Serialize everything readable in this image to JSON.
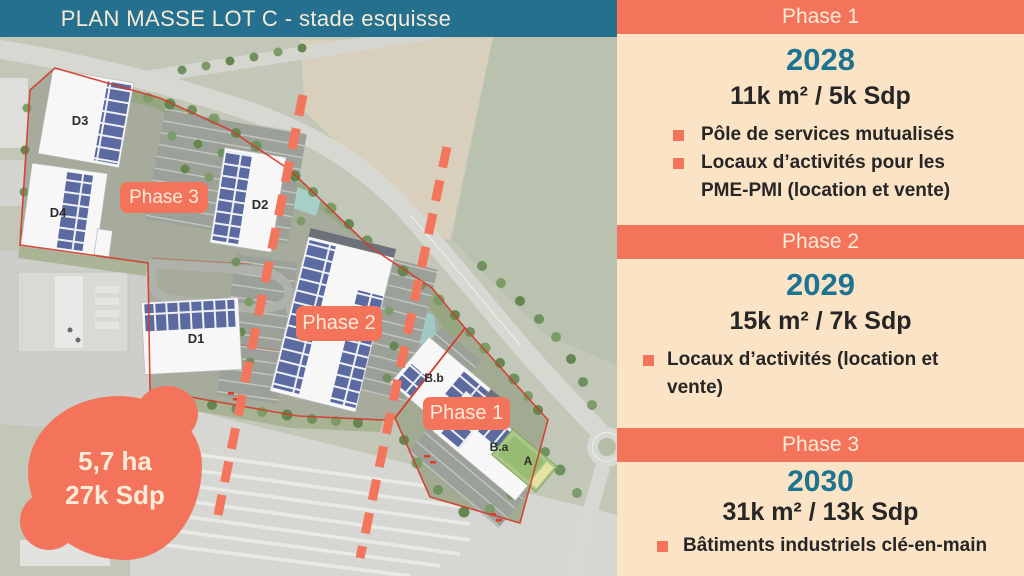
{
  "header": {
    "title": "PLAN MASSE LOT C - stade esquisse"
  },
  "map": {
    "blob": {
      "line1": "5,7 ha",
      "line2": "27k Sdp"
    },
    "phase_badges": [
      {
        "label": "Phase 3"
      },
      {
        "label": "Phase 2"
      },
      {
        "label": "Phase 1"
      }
    ],
    "buildings": {
      "d3": "D3",
      "d4": "D4",
      "d2": "D2",
      "d1": "D1",
      "bb": "B.b",
      "ba": "B.a",
      "a": "A"
    }
  },
  "panel": {
    "sections": [
      {
        "title": "Phase 1",
        "year": "2028",
        "area": "11k m² / 5k Sdp",
        "bullets": [
          "Pôle de services mutualisés",
          "Locaux d’activités pour les PME-PMI (location et vente)"
        ]
      },
      {
        "title": "Phase 2",
        "year": "2029",
        "area": "15k m² / 7k Sdp",
        "bullets": [
          "Locaux d’activités (location et vente)"
        ]
      },
      {
        "title": "Phase 3",
        "year": "2030",
        "area": "31k m² / 13k Sdp",
        "bullets": [
          "Bâtiments industriels clé-en-main"
        ]
      }
    ]
  },
  "colors": {
    "teal": "#25708E",
    "salmon": "#F4745B",
    "panel_cream": "#FBE3C5",
    "text_cream": "#F8ECD9",
    "year_teal": "#1C7392",
    "dark": "#262626",
    "boundary_red": "#D43A2A",
    "panel_blue": "#5B6BA1"
  }
}
